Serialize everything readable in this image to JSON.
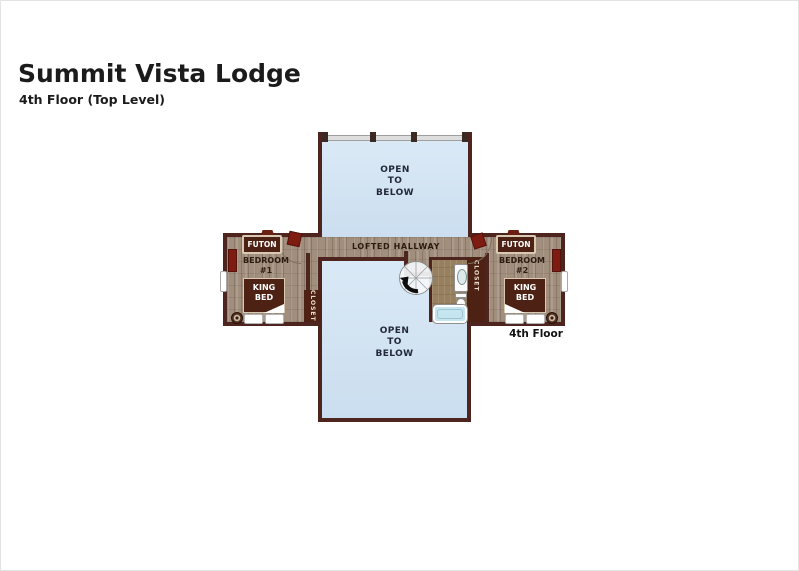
{
  "page": {
    "title": "Summit Vista Lodge",
    "subtitle": "4th Floor (Top Level)",
    "floor_tag": "4th Floor"
  },
  "areas": {
    "open_above": "OPEN\nTO\nBELOW",
    "open_below": "OPEN\nTO\nBELOW",
    "hallway": "LOFTED HALLWAY"
  },
  "bedroom1": {
    "name": "BEDROOM\n#1",
    "futon": "FUTON",
    "bed": "KING\nBED",
    "closet": "CLOSET"
  },
  "bedroom2": {
    "name": "BEDROOM\n#2",
    "futon": "FUTON",
    "bed": "KING\nBED",
    "closet": "CLOSET"
  },
  "bathroom": {
    "fixtures": [
      "sink-vanity",
      "toilet",
      "bathtub"
    ]
  },
  "stairs": {
    "type": "spiral-staircase"
  },
  "colors": {
    "wall": "#4e241e",
    "open_area_blue": "#cfe0ef",
    "wood_floor": "#a18e7d",
    "furniture_dark": "#4d2114",
    "accent_red": "#7e1c12",
    "tub_blue": "#c6e6ef",
    "railing_gray": "#dedede"
  }
}
